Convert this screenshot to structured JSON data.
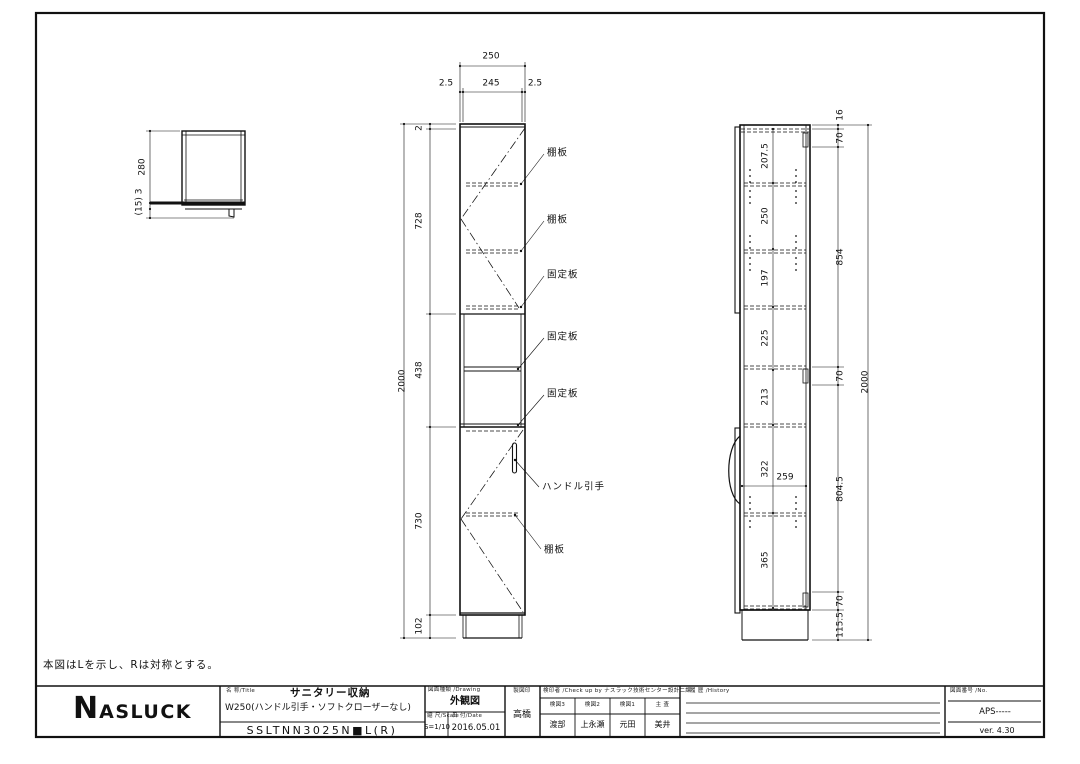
{
  "note": "本図はLを示し、Rは対称とする。",
  "title_block": {
    "logo_initial": "N",
    "logo_rest": "ASLUCK",
    "name_label": "名 称/Title",
    "product_name": "サニタリー収納",
    "product_spec": "W250(ハンドル引手・ソフトクローザーなし)",
    "model_number": "SSLTNN3025N■L(R)",
    "drawing_type_label": "図面種類 /Drawing",
    "drawing_type": "外観図",
    "scale_label": "縮 尺/Scale",
    "scale": "S=1/10",
    "date_label": "日 付/Date",
    "date": "2016.05.01",
    "drafter_label": "製図印",
    "drafter": "高橋",
    "check_label": "検印者 /Check up by ナスラック技術センター設計二課",
    "check_columns": [
      {
        "label": "検図3",
        "name": "渡部"
      },
      {
        "label": "検図2",
        "name": "上永瀬"
      },
      {
        "label": "検図1",
        "name": "元田"
      },
      {
        "label": "主 査",
        "name": "美井"
      }
    ],
    "history_label": "履 歴 /History",
    "number_label": "図面番号 /No.",
    "number": "APS-----",
    "version": "ver. 4.30"
  },
  "views_summary": {
    "plan_view_dims": [
      "280",
      "(15) 3"
    ],
    "front_view_top_dims": [
      "250",
      "2.5",
      "245",
      "2.5"
    ],
    "front_view_left_dims": [
      "2",
      "728",
      "438",
      "730",
      "102",
      "2000"
    ],
    "front_view_part_labels": [
      "棚板",
      "棚板",
      "固定板",
      "固定板",
      "固定板",
      "ハンドル引手",
      "棚板"
    ],
    "side_view_internal_dims": [
      "207.5",
      "250",
      "197",
      "225",
      "213",
      "322",
      "365",
      "259"
    ],
    "side_view_right_dims": [
      "16",
      "70",
      "854",
      "70",
      "804.5",
      "70",
      "115.5",
      "2000"
    ]
  },
  "annotations": [
    {
      "name": "plan-dim-depth",
      "text": "280",
      "x": 143,
      "y": 167,
      "rot": true
    },
    {
      "name": "plan-dim-base",
      "text": "(15) 3",
      "x": 140,
      "y": 202,
      "rot": true
    },
    {
      "name": "front-dim-width-overall",
      "text": "250",
      "x": 491,
      "y": 57
    },
    {
      "name": "front-dim-gap-left",
      "text": "2.5",
      "x": 446,
      "y": 84
    },
    {
      "name": "front-dim-width-inner",
      "text": "245",
      "x": 491,
      "y": 84
    },
    {
      "name": "front-dim-gap-right",
      "text": "2.5",
      "x": 535,
      "y": 84
    },
    {
      "name": "front-dim-top-panel",
      "text": "2",
      "x": 420,
      "y": 128,
      "rot": true
    },
    {
      "name": "front-dim-upper-door",
      "text": "728",
      "x": 420,
      "y": 221,
      "rot": true
    },
    {
      "name": "front-dim-open-section",
      "text": "438",
      "x": 420,
      "y": 370,
      "rot": true
    },
    {
      "name": "front-dim-lower-door",
      "text": "730",
      "x": 420,
      "y": 521,
      "rot": true
    },
    {
      "name": "front-dim-base",
      "text": "102",
      "x": 420,
      "y": 626,
      "rot": true
    },
    {
      "name": "front-dim-overall-height",
      "text": "2000",
      "x": 403,
      "y": 381,
      "rot": true
    },
    {
      "name": "part-label-shelf-1",
      "text": "棚板",
      "x": 547,
      "y": 153,
      "anchor": "l"
    },
    {
      "name": "part-label-shelf-2",
      "text": "棚板",
      "x": 547,
      "y": 220,
      "anchor": "l"
    },
    {
      "name": "part-label-fixed-1",
      "text": "固定板",
      "x": 547,
      "y": 275,
      "anchor": "l"
    },
    {
      "name": "part-label-fixed-2",
      "text": "固定板",
      "x": 547,
      "y": 337,
      "anchor": "l"
    },
    {
      "name": "part-label-fixed-3",
      "text": "固定板",
      "x": 547,
      "y": 394,
      "anchor": "l"
    },
    {
      "name": "part-label-handle",
      "text": "ハンドル引手",
      "x": 542,
      "y": 487,
      "anchor": "l"
    },
    {
      "name": "part-label-shelf-3",
      "text": "棚板",
      "x": 544,
      "y": 550,
      "anchor": "l"
    },
    {
      "name": "side-dim-207",
      "text": "207.5",
      "x": 766,
      "y": 156,
      "rot": true
    },
    {
      "name": "side-dim-250",
      "text": "250",
      "x": 766,
      "y": 216,
      "rot": true
    },
    {
      "name": "side-dim-197",
      "text": "197",
      "x": 766,
      "y": 278,
      "rot": true
    },
    {
      "name": "side-dim-225",
      "text": "225",
      "x": 766,
      "y": 338,
      "rot": true
    },
    {
      "name": "side-dim-213",
      "text": "213",
      "x": 766,
      "y": 397,
      "rot": true
    },
    {
      "name": "side-dim-322",
      "text": "322",
      "x": 766,
      "y": 469,
      "rot": true
    },
    {
      "name": "side-dim-365",
      "text": "365",
      "x": 766,
      "y": 560,
      "rot": true
    },
    {
      "name": "side-dim-depth-259",
      "text": "259",
      "x": 785,
      "y": 478
    },
    {
      "name": "side-rdim-16",
      "text": "16",
      "x": 841,
      "y": 115,
      "rot": true
    },
    {
      "name": "side-rdim-70a",
      "text": "70",
      "x": 841,
      "y": 138,
      "rot": true
    },
    {
      "name": "side-rdim-854",
      "text": "854",
      "x": 841,
      "y": 257,
      "rot": true
    },
    {
      "name": "side-rdim-70b",
      "text": "70",
      "x": 841,
      "y": 376,
      "rot": true
    },
    {
      "name": "side-rdim-804",
      "text": "804.5",
      "x": 841,
      "y": 489,
      "rot": true
    },
    {
      "name": "side-rdim-70c",
      "text": "70",
      "x": 841,
      "y": 601,
      "rot": true
    },
    {
      "name": "side-rdim-115",
      "text": "115.5",
      "x": 841,
      "y": 625,
      "rot": true
    },
    {
      "name": "side-dim-overall-height",
      "text": "2000",
      "x": 866,
      "y": 382,
      "rot": true
    }
  ]
}
